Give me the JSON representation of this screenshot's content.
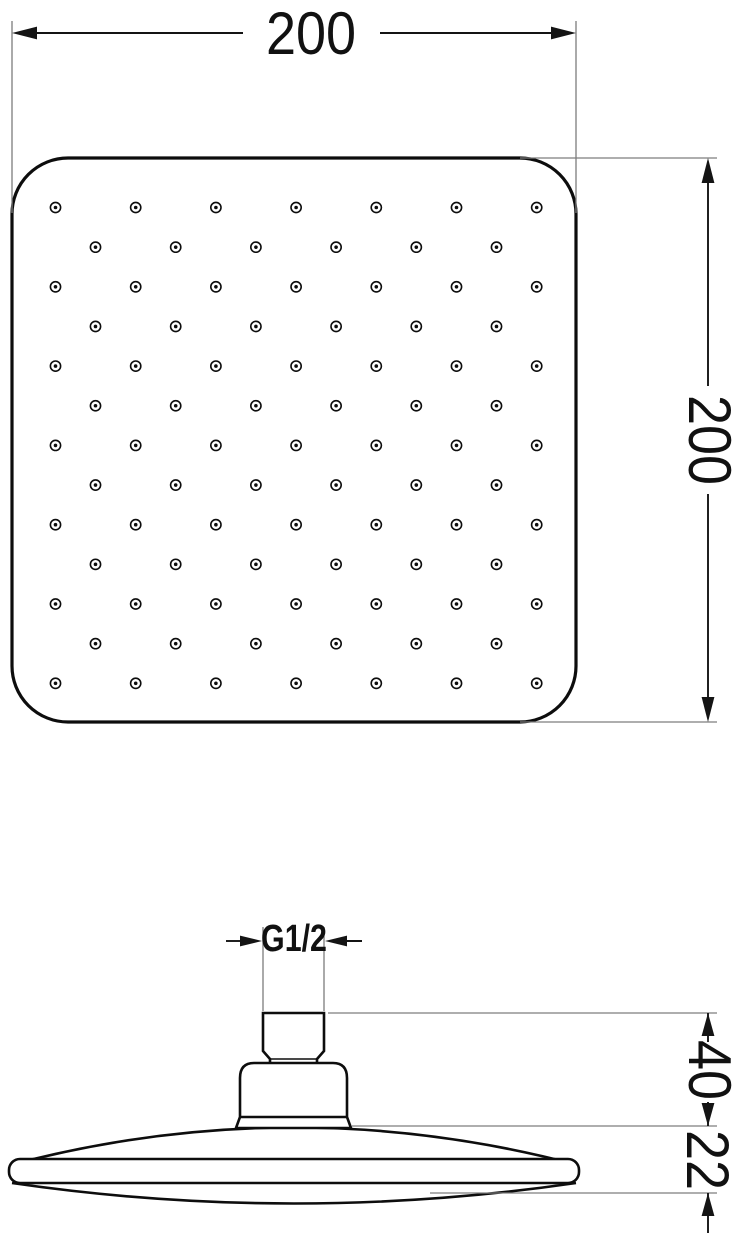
{
  "colors": {
    "background": "#ffffff",
    "line": "#0d0d0d",
    "dim": "#141414",
    "ext": "#7d7d7d",
    "text": "#111111"
  },
  "top_view": {
    "name": "shower head face - top view",
    "width_dimension": {
      "value": "200"
    },
    "height_dimension": {
      "value": "200"
    },
    "nozzle_grid": {
      "rows": 13,
      "start_y": 207.5,
      "row_step": 39.65,
      "odd_row": {
        "count": 7,
        "start_x": 55.5,
        "step_x": 80.2
      },
      "even_row": {
        "count": 6,
        "start_x": 95.5,
        "step_x": 80.2
      },
      "outer_radius": 5.1,
      "outer_stroke": 1.6,
      "inner_radius": 1.8
    }
  },
  "side_view": {
    "name": "shower head profile - side view",
    "thread_dimension": {
      "value": "G1/2"
    },
    "connector_height_dimension": {
      "value": "40"
    },
    "head_thickness_dimension": {
      "value": "22"
    }
  }
}
